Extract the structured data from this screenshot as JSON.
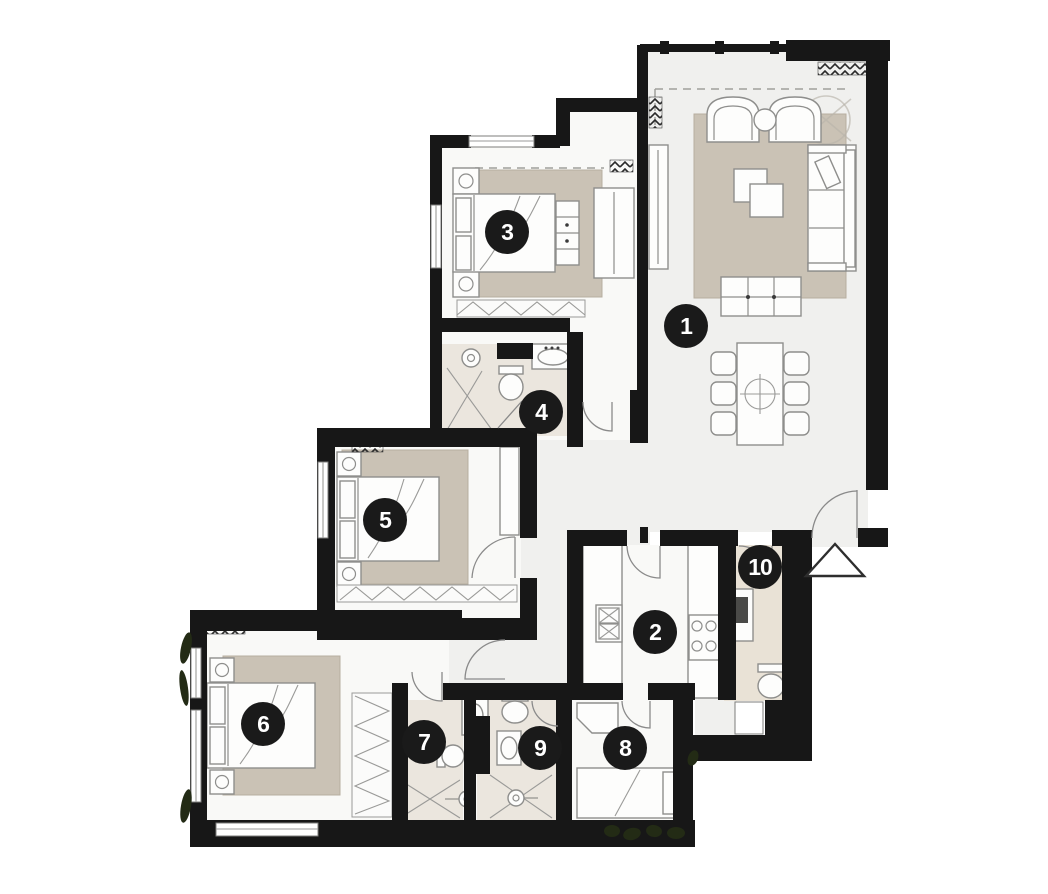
{
  "canvas": {
    "width": 1048,
    "height": 894,
    "background": "#ffffff"
  },
  "floorplan": {
    "kind": "apartment-floor-plan",
    "colors": {
      "wall": "#171717",
      "floor": "#f0f0ee",
      "floor_bright": "#f9f9f7",
      "rug": "#cac2b5",
      "bath_floor": "#ebe6de",
      "utility_floor": "#e9e2d6",
      "furniture_fill": "#fdfdfc",
      "furniture_stroke": "#8e8e8c",
      "marker_bg": "#1a1a1a",
      "marker_text": "#ffffff",
      "plant": "#232b15",
      "dash": "#a0a09c"
    },
    "markers": [
      {
        "label": "1",
        "x": 686,
        "y": 326
      },
      {
        "label": "2",
        "x": 655,
        "y": 632
      },
      {
        "label": "3",
        "x": 507,
        "y": 232
      },
      {
        "label": "4",
        "x": 541,
        "y": 412
      },
      {
        "label": "5",
        "x": 385,
        "y": 520
      },
      {
        "label": "6",
        "x": 263,
        "y": 724
      },
      {
        "label": "7",
        "x": 424,
        "y": 742
      },
      {
        "label": "8",
        "x": 625,
        "y": 748
      },
      {
        "label": "9",
        "x": 540,
        "y": 748
      },
      {
        "label": "10",
        "x": 760,
        "y": 567
      }
    ],
    "symbols": {
      "entrance_arrow": {
        "x": 835,
        "y": 560
      }
    }
  }
}
